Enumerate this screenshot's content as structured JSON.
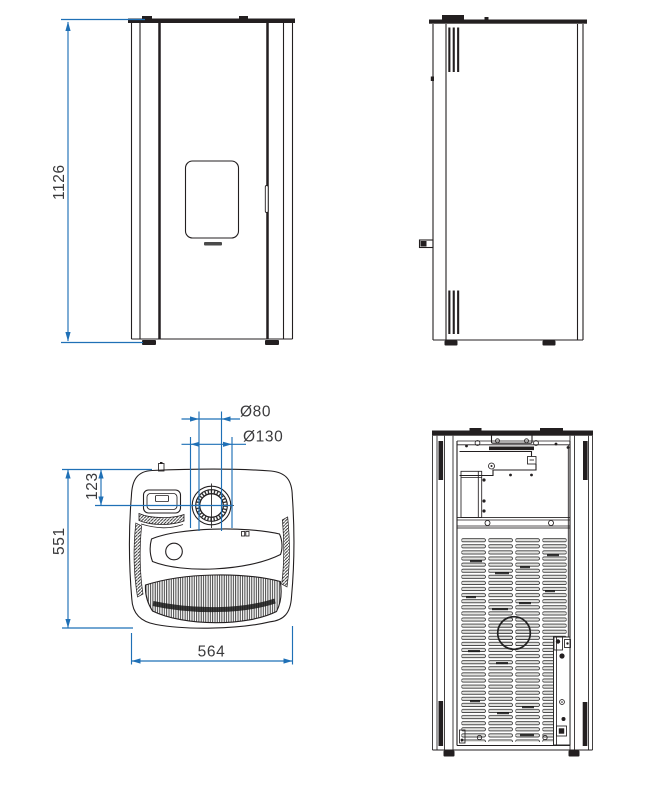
{
  "colors": {
    "dim_blue": "#1f70b6",
    "line_dark": "#231f20",
    "label_gray": "#3a3a3c"
  },
  "dims": {
    "overall_height": "1126",
    "flue_offset_from_back": "123",
    "overall_depth": "551",
    "overall_width": "564",
    "flue_pipe_diameter": "Ø80",
    "air_intake_diameter": "Ø130"
  }
}
